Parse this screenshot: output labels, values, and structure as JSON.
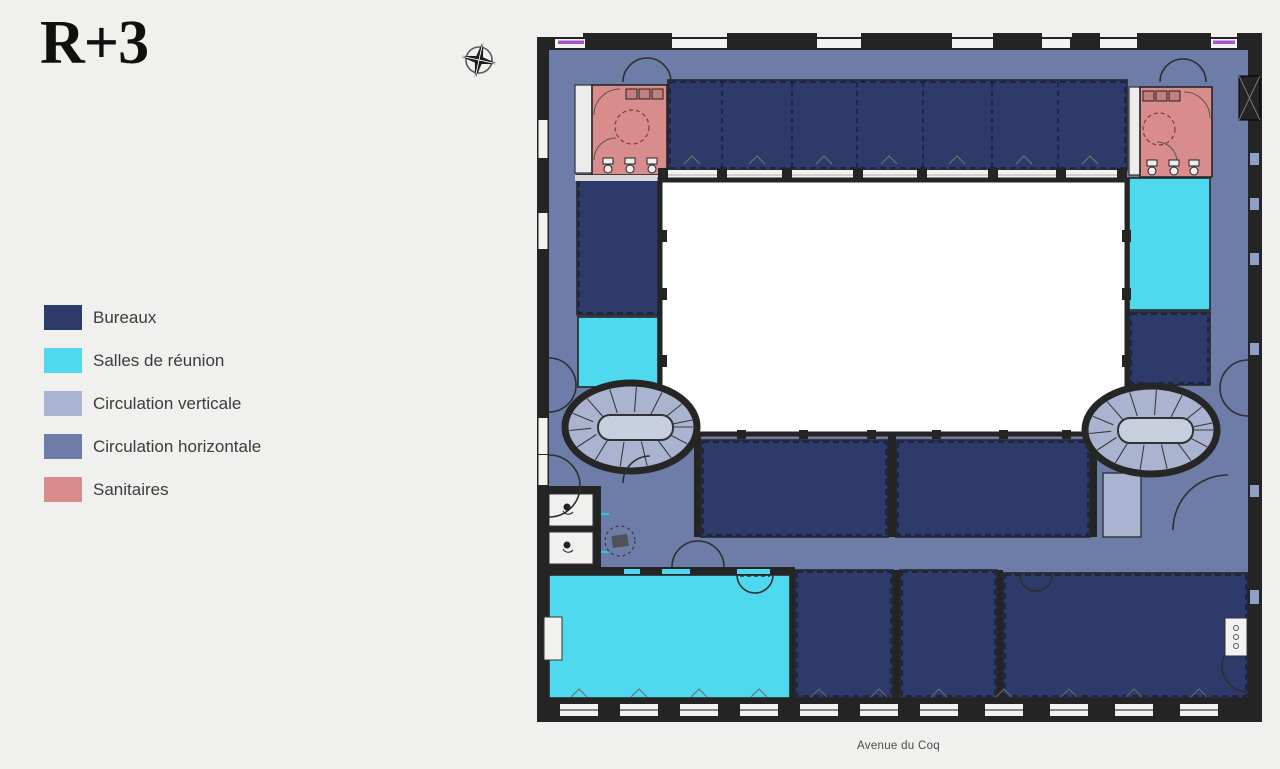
{
  "page": {
    "title": "R+3",
    "background_color": "#f0f0ee"
  },
  "compass": {
    "name": "compass-rose"
  },
  "legend": {
    "items": [
      {
        "id": "bureaux",
        "label": "Bureaux",
        "color": "#2e3a6a"
      },
      {
        "id": "salles",
        "label": "Salles de réunion",
        "color": "#4fd9ef"
      },
      {
        "id": "circ-vert",
        "label": "Circulation verticale",
        "color": "#aab4d0"
      },
      {
        "id": "circ-horiz",
        "label": "Circulation horizontale",
        "color": "#6d7da7"
      },
      {
        "id": "sanitaires",
        "label": "Sanitaires",
        "color": "#d98c8c"
      }
    ]
  },
  "plan": {
    "street_label": "Avenue du Coq",
    "colors": {
      "bg": "#f0f0ee",
      "wall": "#242424",
      "courtyard": "#ffffff",
      "window": "#f2f2f0",
      "stair-inner": "#c7cede",
      "accent": "#a855c8",
      "slot": "#8fa0c6"
    }
  }
}
